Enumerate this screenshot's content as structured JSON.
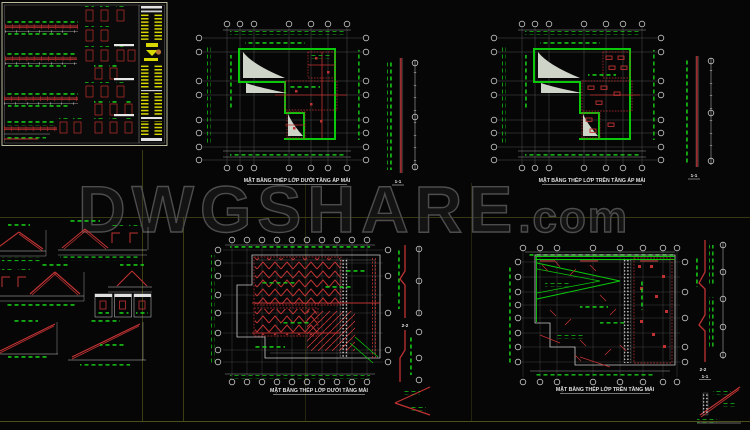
{
  "watermark": {
    "main": "DWGSHARE",
    "suffix": ".com"
  },
  "panels": {
    "top_left": {
      "description_note": ""
    },
    "top_middle": {
      "title": "MẶT BẰNG THÉP LỚP DƯỚI TẦNG ÁP MÁI",
      "section_label": "1-1"
    },
    "top_right": {
      "title": "MẶT BẰNG THÉP LỚP TRÊN TẦNG ÁP MÁI",
      "section_label": "1-1"
    },
    "bottom_middle": {
      "title": "MẶT BẰNG THÉP LỚP DƯỚI TẦNG MÁI",
      "section_label": "2-2"
    },
    "bottom_right": {
      "title": "MẶT BẰNG THÉP LỚP TRÊN TẦNG MÁI",
      "section_label_zigzag": "2-2",
      "section_label_slope": "1-1"
    }
  },
  "colors": {
    "background": "#060607",
    "cad_green": "#0ac80a",
    "cad_red": "#c03232",
    "cad_yellow": "#d8d800",
    "line_white": "#c8c8c8",
    "frame_olive": "#62621e",
    "watermark_gray": "#4d4d4d"
  }
}
